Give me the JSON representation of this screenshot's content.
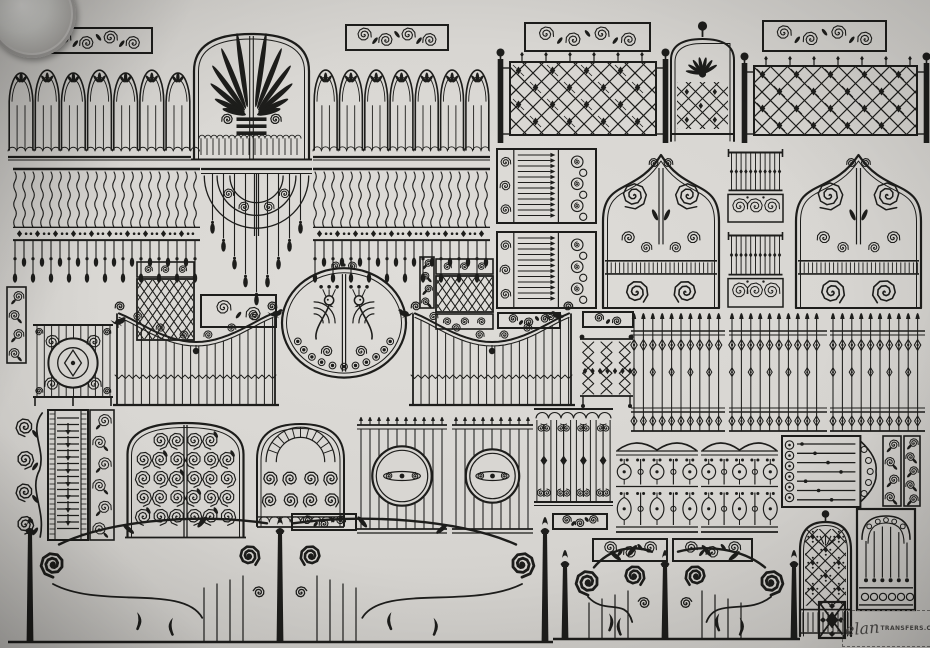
{
  "colors": {
    "ink": "#1d1d1b",
    "paper": "#d8d6d2",
    "watermark": "#4a4846"
  },
  "watermark": {
    "script": "elan",
    "domain": "TRANSFERS.COM"
  },
  "coin": {
    "present": true,
    "position": "top-left-corner"
  },
  "birds": [
    {
      "x": 114,
      "y": 314,
      "flip": false
    },
    {
      "x": 271,
      "y": 306,
      "flip": false
    },
    {
      "x": 410,
      "y": 306,
      "flip": true
    },
    {
      "x": 563,
      "y": 308,
      "flip": true
    }
  ],
  "panels": [
    {
      "name": "scroll-border-strip",
      "type": "scrollStrip",
      "x": 44,
      "y": 27,
      "w": 109,
      "h": 27
    },
    {
      "name": "arched-picket-fence",
      "type": "archedFence",
      "x": 8,
      "y": 58,
      "w": 183,
      "h": 103
    },
    {
      "name": "palm-arch-gate",
      "type": "palmGate",
      "x": 191,
      "y": 27,
      "w": 121,
      "h": 134
    },
    {
      "name": "scroll-border-strip",
      "type": "scrollStrip",
      "x": 345,
      "y": 24,
      "w": 104,
      "h": 27
    },
    {
      "name": "arched-picket-fence",
      "type": "archedFence",
      "x": 313,
      "y": 58,
      "w": 177,
      "h": 103
    },
    {
      "name": "scroll-border-strip",
      "type": "scrollStrip",
      "x": 524,
      "y": 22,
      "w": 127,
      "h": 30
    },
    {
      "name": "diamond-lattice-fence",
      "type": "xLattice",
      "x": 497,
      "y": 46,
      "w": 172,
      "h": 97
    },
    {
      "name": "arched-sunburst-gate",
      "type": "archGate",
      "x": 666,
      "y": 20,
      "w": 73,
      "h": 123
    },
    {
      "name": "scroll-border-strip",
      "type": "scrollStrip",
      "x": 762,
      "y": 20,
      "w": 125,
      "h": 32
    },
    {
      "name": "diamond-lattice-fence",
      "type": "xLattice",
      "x": 741,
      "y": 50,
      "w": 189,
      "h": 93
    },
    {
      "name": "wavy-baluster-fence",
      "type": "balusterFence",
      "x": 13,
      "y": 167,
      "w": 187,
      "h": 116
    },
    {
      "name": "fan-drop-centerpiece",
      "type": "fanDrop",
      "x": 201,
      "y": 167,
      "w": 111,
      "h": 138
    },
    {
      "name": "wavy-baluster-fence",
      "type": "balusterFence",
      "x": 313,
      "y": 167,
      "w": 177,
      "h": 116
    },
    {
      "name": "bar-and-scroll-panel",
      "type": "barScrollPanel",
      "x": 497,
      "y": 149,
      "w": 99,
      "h": 74
    },
    {
      "name": "bar-and-scroll-panel",
      "type": "barScrollPanel",
      "x": 497,
      "y": 232,
      "w": 99,
      "h": 76
    },
    {
      "name": "ogee-scroll-gate",
      "type": "ogeeGate",
      "x": 599,
      "y": 146,
      "w": 124,
      "h": 164
    },
    {
      "name": "picket-scroll-panel",
      "type": "picketScrollStack",
      "x": 727,
      "y": 149,
      "w": 57,
      "h": 74
    },
    {
      "name": "picket-scroll-panel",
      "type": "picketScrollStack",
      "x": 727,
      "y": 232,
      "w": 57,
      "h": 76
    },
    {
      "name": "ogee-scroll-gate",
      "type": "ogeeGate",
      "x": 792,
      "y": 146,
      "w": 133,
      "h": 164
    },
    {
      "name": "vertical-scroll-border",
      "type": "vborder",
      "x": 7,
      "y": 287,
      "w": 19,
      "h": 76
    },
    {
      "name": "medallion-gate",
      "type": "medallionGate",
      "x": 32,
      "y": 321,
      "w": 82,
      "h": 85
    },
    {
      "name": "lattice-panel-scroll-header",
      "type": "latticePanel",
      "x": 137,
      "y": 262,
      "w": 57,
      "h": 80,
      "o": {
        "footer": false
      }
    },
    {
      "name": "scroll-border-strip",
      "type": "scrollStrip",
      "x": 200,
      "y": 294,
      "w": 77,
      "h": 34
    },
    {
      "name": "peacock-oval-medallion",
      "type": "peacockOval",
      "x": 279,
      "y": 261,
      "w": 130,
      "h": 119
    },
    {
      "name": "swag-picket-fence",
      "type": "swagFence",
      "x": 113,
      "y": 298,
      "w": 166,
      "h": 110
    },
    {
      "name": "swag-picket-fence",
      "type": "swagFence",
      "x": 409,
      "y": 298,
      "w": 166,
      "h": 110
    },
    {
      "name": "vertical-scroll-border",
      "type": "vborder",
      "x": 420,
      "y": 257,
      "w": 14,
      "h": 51
    },
    {
      "name": "lattice-panel-scroll-borders",
      "type": "latticePanel",
      "x": 436,
      "y": 259,
      "w": 57,
      "h": 70,
      "o": {
        "footer": true
      }
    },
    {
      "name": "scroll-border-strip",
      "type": "scrollStrip",
      "x": 497,
      "y": 312,
      "w": 64,
      "h": 17
    },
    {
      "name": "scroll-border-strip",
      "type": "scrollStrip",
      "x": 582,
      "y": 311,
      "w": 52,
      "h": 17
    },
    {
      "name": "zigzag-lattice-panel",
      "type": "zigzagPanel",
      "x": 579,
      "y": 334,
      "w": 55,
      "h": 74
    },
    {
      "name": "spear-picket-fence",
      "type": "spearFence",
      "x": 631,
      "y": 305,
      "w": 94,
      "h": 129
    },
    {
      "name": "spear-picket-fence",
      "type": "spearFence",
      "x": 729,
      "y": 305,
      "w": 98,
      "h": 129
    },
    {
      "name": "spear-picket-fence",
      "type": "spearFence",
      "x": 830,
      "y": 305,
      "w": 95,
      "h": 129
    },
    {
      "name": "leafy-scroll-border",
      "type": "vineBorder",
      "x": 14,
      "y": 410,
      "w": 32,
      "h": 130
    },
    {
      "name": "louver-arrow-column",
      "type": "slatColumn",
      "x": 48,
      "y": 410,
      "w": 40,
      "h": 130
    },
    {
      "name": "vertical-scroll-border",
      "type": "vborder",
      "x": 90,
      "y": 410,
      "w": 24,
      "h": 130
    },
    {
      "name": "dense-scroll-double-gate",
      "type": "denseScrollGate",
      "x": 125,
      "y": 418,
      "w": 121,
      "h": 121
    },
    {
      "name": "arched-scroll-window",
      "type": "archWindow",
      "x": 254,
      "y": 416,
      "w": 93,
      "h": 114
    },
    {
      "name": "scroll-border-strip",
      "type": "scrollStrip",
      "x": 291,
      "y": 513,
      "w": 66,
      "h": 18
    },
    {
      "name": "circle-medallion-gate",
      "type": "circleGate",
      "x": 357,
      "y": 412,
      "w": 90,
      "h": 123
    },
    {
      "name": "circle-medallion-gate",
      "type": "circleGate",
      "x": 452,
      "y": 412,
      "w": 81,
      "h": 123
    },
    {
      "name": "baluster-grid-panel",
      "type": "balusterGrid",
      "x": 534,
      "y": 406,
      "w": 79,
      "h": 104
    },
    {
      "name": "scroll-border-strip",
      "type": "scrollStrip",
      "x": 552,
      "y": 513,
      "w": 56,
      "h": 17
    },
    {
      "name": "wavy-baluster-panel",
      "type": "wavyBalusterPanel",
      "x": 616,
      "y": 436,
      "w": 82,
      "h": 101
    },
    {
      "name": "wavy-baluster-panel",
      "type": "wavyBalusterPanel",
      "x": 701,
      "y": 436,
      "w": 77,
      "h": 101
    },
    {
      "name": "bar-gate-with-keystone",
      "type": "hbarGate",
      "x": 782,
      "y": 436,
      "w": 98,
      "h": 71
    },
    {
      "name": "vertical-scroll-border",
      "type": "vborder",
      "x": 883,
      "y": 436,
      "w": 18,
      "h": 70
    },
    {
      "name": "vertical-scroll-border",
      "type": "vborder",
      "x": 904,
      "y": 436,
      "w": 16,
      "h": 70
    },
    {
      "name": "scroll-border-strip",
      "type": "scrollStrip",
      "x": 592,
      "y": 538,
      "w": 76,
      "h": 24
    },
    {
      "name": "scroll-border-strip",
      "type": "scrollStrip",
      "x": 672,
      "y": 538,
      "w": 81,
      "h": 24
    },
    {
      "name": "art-nouveau-driveway-gate",
      "type": "nouveauGate",
      "x": 8,
      "y": 505,
      "w": 545,
      "h": 141,
      "o": {
        "posts": [
          22,
          272,
          537
        ]
      }
    },
    {
      "name": "art-nouveau-gate",
      "type": "nouveauGate",
      "x": 553,
      "y": 538,
      "w": 247,
      "h": 105,
      "o": {
        "posts": [
          12,
          112,
          241
        ]
      }
    },
    {
      "name": "arched-lattice-door",
      "type": "archDoor",
      "x": 797,
      "y": 509,
      "w": 57,
      "h": 129
    },
    {
      "name": "arched-bar-grille",
      "type": "rectGrille",
      "x": 857,
      "y": 509,
      "w": 58,
      "h": 101
    },
    {
      "name": "diamond-cross-square",
      "type": "xSquare",
      "x": 818,
      "y": 601,
      "w": 28,
      "h": 38
    }
  ]
}
